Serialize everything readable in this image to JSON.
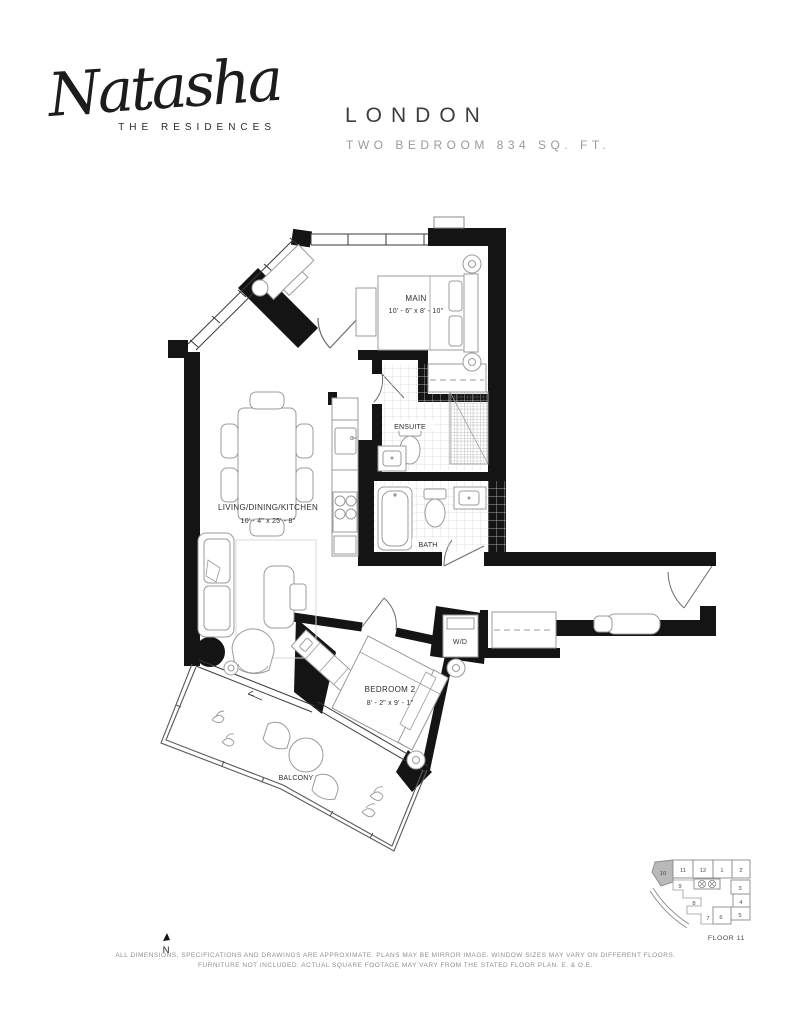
{
  "logo": {
    "name": "Natasha",
    "tagline": "THE RESIDENCES"
  },
  "plan": {
    "title": "LONDON",
    "subtitle": "TWO BEDROOM 834 SQ. FT."
  },
  "rooms": {
    "main": {
      "label": "MAIN",
      "dims": "10' - 6\" x 8' - 10\""
    },
    "ensuite": {
      "label": "ENSUITE"
    },
    "living": {
      "label": "LIVING/DINING/KITCHEN",
      "dims": "10' - 4\" x 25' - 8\""
    },
    "bath": {
      "label": "BATH"
    },
    "wd": {
      "label": "W/D"
    },
    "bedroom2": {
      "label": "BEDROOM 2",
      "dims": "8' - 2\" x 9' - 1\""
    },
    "balcony": {
      "label": "BALCONY"
    }
  },
  "keyplan": {
    "floor_label": "FLOOR 11",
    "highlighted_unit": "10",
    "units": [
      "10",
      "11",
      "12",
      "1",
      "2",
      "3",
      "4",
      "5",
      "9",
      "8",
      "7",
      "6"
    ]
  },
  "compass": {
    "label": "N"
  },
  "disclaimer": {
    "line1": "ALL DIMENSIONS, SPECIFICATIONS AND DRAWINGS ARE APPROXIMATE. PLANS MAY BE MIRROR IMAGE. WINDOW SIZES MAY VARY ON DIFFERENT FLOORS.",
    "line2": "FURNITURE NOT INCLUDED. ACTUAL SQUARE FOOTAGE MAY VARY FROM THE STATED FLOOR PLAN. E. & O.E."
  },
  "colors": {
    "wall": "#141414",
    "furniture_line": "#9b9b9b",
    "highlight": "#b9b9b9"
  }
}
